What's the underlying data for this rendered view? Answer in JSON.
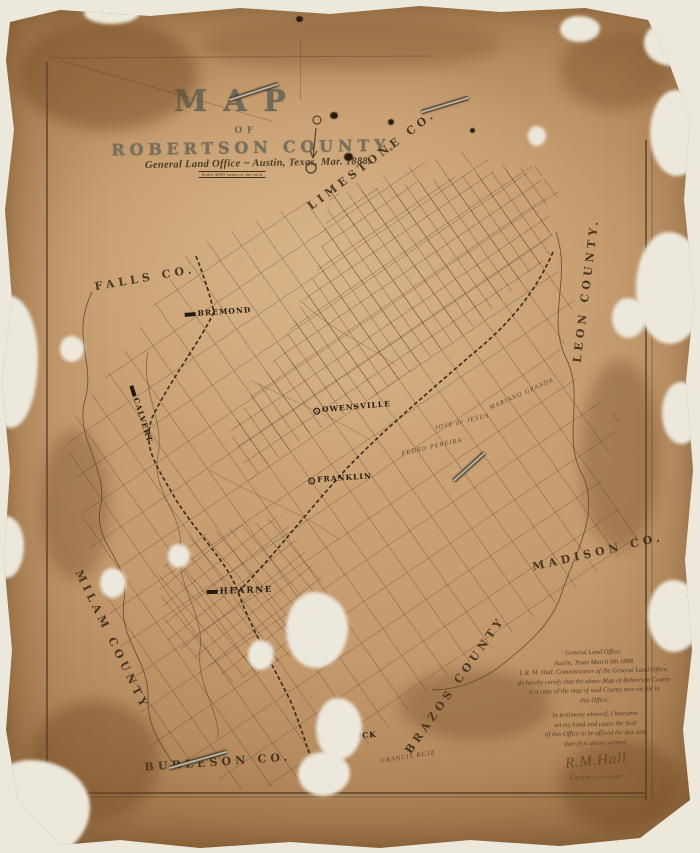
{
  "map": {
    "title": "MAP",
    "of": "OF",
    "county_title": "ROBERTSON COUNTY.",
    "subtitle": "General Land Office ~ Austin, Texas, Mar. 1888.",
    "scale_note": "Scale 4000 varas to the inch"
  },
  "counties": [
    {
      "label": "FALLS CO."
    },
    {
      "label": "LIMESTONE CO."
    },
    {
      "label": "LEON COUNTY."
    },
    {
      "label": "MADISON CO."
    },
    {
      "label": "BRAZOS COUNTY"
    },
    {
      "label": "MILAM COUNTY"
    },
    {
      "label": "BURLESON CO."
    }
  ],
  "towns": [
    {
      "label": "BREMOND"
    },
    {
      "label": "CALVERT"
    },
    {
      "label": "OWENSVILLE"
    },
    {
      "label": "FRANKLIN"
    },
    {
      "label": "HEARNE"
    },
    {
      "label": "WHEELOCK"
    }
  ],
  "surveys": [
    {
      "label": "PEDRO PEREIRA"
    },
    {
      "label": "JOSE de JESUS"
    },
    {
      "label": "MARIANO GRANDE"
    },
    {
      "label": "FRANCIS RUIZ"
    }
  ],
  "certification": {
    "lines": [
      {
        "text": "General Land Office,"
      },
      {
        "text": "Austin, Texas March 9th 1888"
      },
      {
        "text": "I, R. M. Hall, Commissioner of the General Land Office,"
      },
      {
        "text": "do hereby certify that the above Map of Robertson County"
      },
      {
        "text": "is a copy of the map of said County now on file in"
      },
      {
        "text": "this Office."
      },
      {
        "text": "In testimony whereof, I hereunto"
      },
      {
        "text": "set my hand and cause the Seal"
      },
      {
        "text": "of this Office to be affixed the day and"
      },
      {
        "text": "date first above written."
      }
    ],
    "signature": "R.M.Hall",
    "signer_title": "Commissioner"
  },
  "colors": {
    "paper": "#c49a6c",
    "ink": "#352a1c",
    "scan_background": "#ece8dc"
  }
}
